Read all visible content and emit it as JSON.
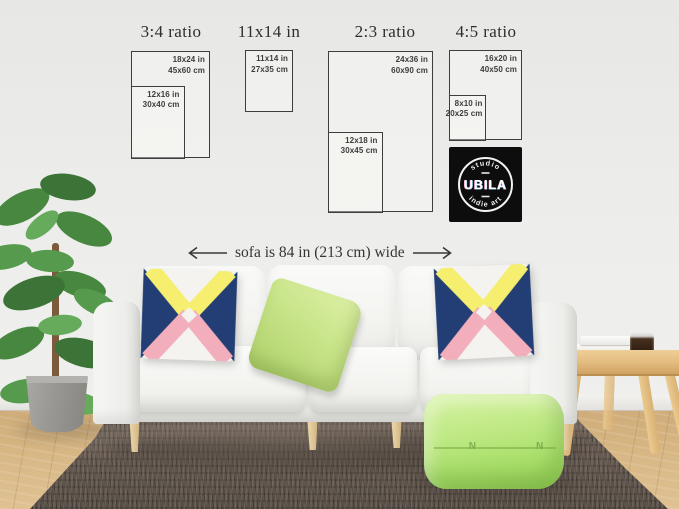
{
  "size_guide": {
    "columns": [
      {
        "title": "3:4 ratio",
        "outer_in": "18x24 in",
        "outer_cm": "45x60 cm",
        "inner_in": "12x16 in",
        "inner_cm": "30x40 cm"
      },
      {
        "title": "11x14 in",
        "outer_in": "11x14 in",
        "outer_cm": "27x35 cm"
      },
      {
        "title": "2:3 ratio",
        "outer_in": "24x36 in",
        "outer_cm": "60x90 cm",
        "inner_in": "12x18 in",
        "inner_cm": "30x45 cm"
      },
      {
        "title": "4:5 ratio",
        "outer_in": "16x20 in",
        "outer_cm": "40x50 cm",
        "inner_in": "8x10 in",
        "inner_cm": "20x25 cm"
      }
    ]
  },
  "logo": {
    "arc_top": "studio",
    "name": "UBILA",
    "arc_bottom": "indie art"
  },
  "annotation": {
    "sofa_width": "sofa is 84 in (213 cm) wide"
  },
  "pouf": {
    "stitch_mark": "N"
  },
  "colors": {
    "wall": "#ececea",
    "frame_line": "#3e3e3e",
    "text": "#333333",
    "logo_bg": "#0d0d0d",
    "logo_pink": "#ff8fb0",
    "logo_cyan": "#8fd4ff",
    "sofa": "#f6f6f4",
    "pillow_navy": "#223e74",
    "pillow_yellow": "#f5ee6e",
    "pillow_pink": "#f3aebc",
    "pillow_green": "#c8e488",
    "pouf_green": "#aade6c",
    "rug": "#6b5e55",
    "floor": "#d8b887",
    "table_wood": "#e5c084"
  }
}
